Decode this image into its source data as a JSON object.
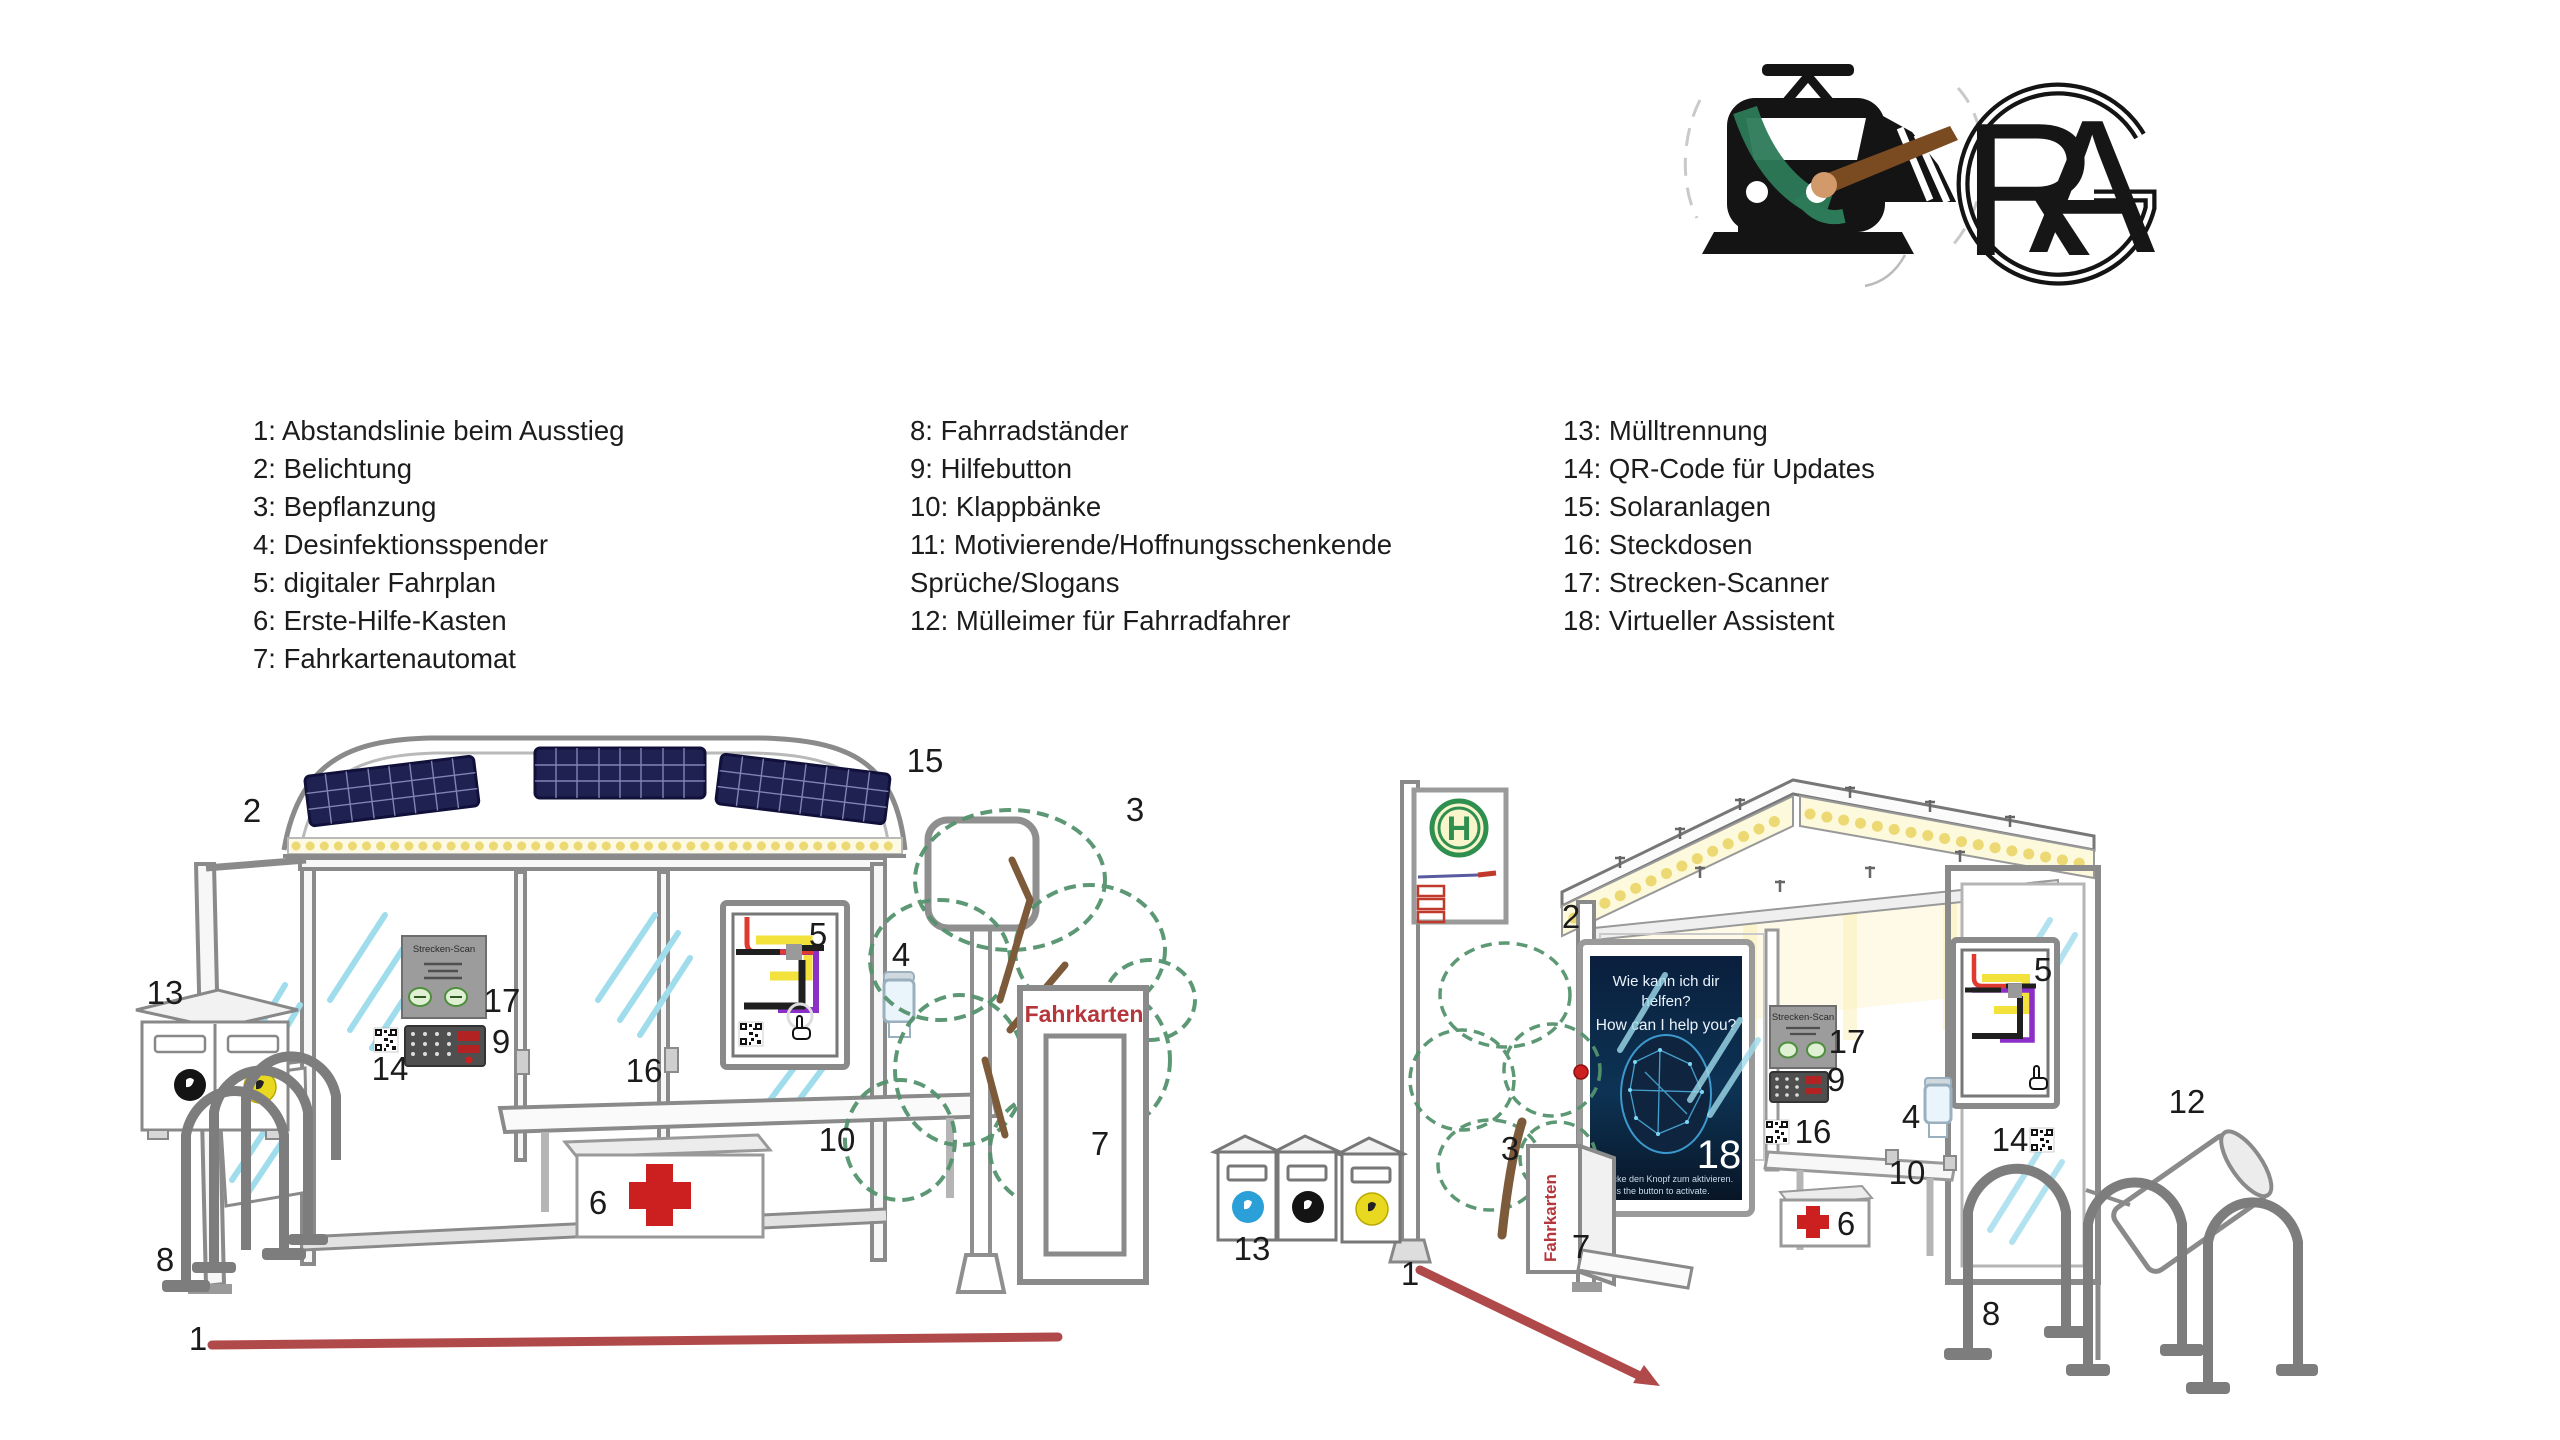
{
  "header": {
    "train_logo": "train-with-paintbrush-logo",
    "rag_letters": {
      "r": "R",
      "a": "A",
      "g": "G"
    }
  },
  "legend": {
    "columns": [
      {
        "items": [
          "1: Abstandslinie beim Ausstieg",
          "2: Belichtung",
          "3: Bepflanzung",
          "4: Desinfektionsspender",
          "5: digitaler Fahrplan",
          "6: Erste-Hilfe-Kasten",
          "7: Fahrkartenautomat"
        ]
      },
      {
        "items": [
          "8: Fahrradständer",
          "9: Hilfebutton",
          "10: Klappbänke",
          "11: Motivierende/Hoffnungsschenkende Sprüche/Slogans",
          "12: Mülleimer für Fahrradfahrer"
        ]
      },
      {
        "items": [
          "13: Mülltrennung",
          "14: QR-Code für Updates",
          "15: Solaranlagen",
          "16: Steckdosen",
          "17: Strecken-Scanner",
          "18: Virtueller Assistent"
        ]
      }
    ]
  },
  "scene": {
    "colors": {
      "accent_red_line": "#b04a4a",
      "solar_panel": "#1f2150",
      "light_dots": "#edd973",
      "glass_streak": "#9fdcec",
      "fahrkarten_red": "#b5373b",
      "assistant_screen": "#0a1f3d",
      "tree_green": "#55936e",
      "cross_red": "#cc1f1f"
    },
    "shared": {
      "scanner_title": "Strecken-Scan",
      "fahrkarten": "Fahrkarten",
      "h_sign": "H"
    },
    "left": {
      "callouts": {
        "n1": "1",
        "n2": "2",
        "n3": "3",
        "n4": "4",
        "n5": "5",
        "n6": "6",
        "n7": "7",
        "n8": "8",
        "n9": "9",
        "n10": "10",
        "n13": "13",
        "n14": "14",
        "n15": "15",
        "n16": "16",
        "n17": "17"
      }
    },
    "right": {
      "callouts": {
        "n1": "1",
        "n2": "2",
        "n3": "3",
        "n4": "4",
        "n5": "5",
        "n6": "6",
        "n7": "7",
        "n8": "8",
        "n9": "9",
        "n10": "10",
        "n12": "12",
        "n13": "13",
        "n14": "14",
        "n16": "16",
        "n17": "17"
      },
      "assistant": {
        "line1": "Wie kann ich dir",
        "line2": "helfen?",
        "line3": "How can I help you?",
        "number": "18",
        "footer1": "Drücke den Knopf zum aktivieren.",
        "footer2": "Press the button to activate."
      }
    }
  }
}
